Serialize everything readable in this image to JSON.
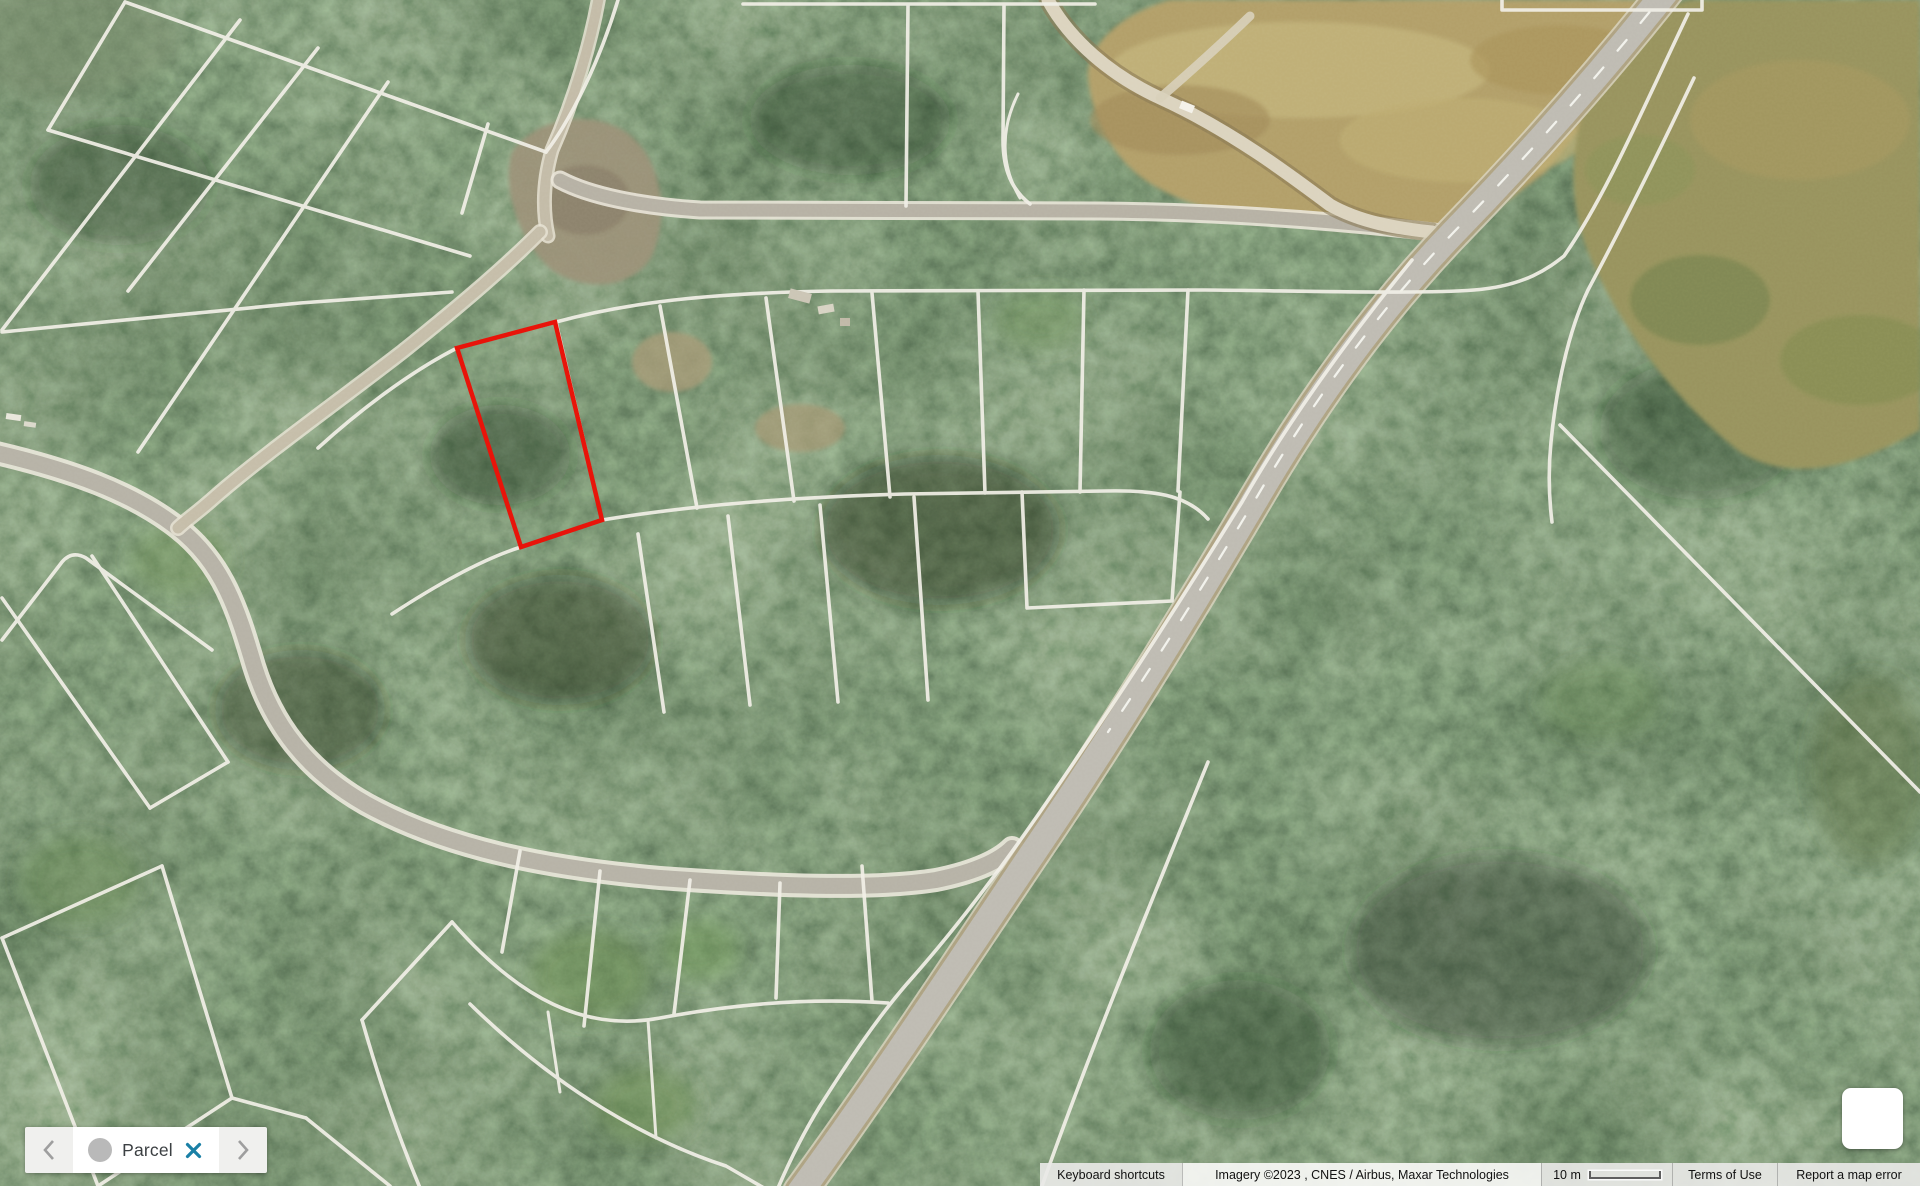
{
  "map": {
    "type": "satellite-imagery",
    "highlighted_parcel_color": "#e81309",
    "parcel_line_color": "#f1efe7"
  },
  "parcel_chip": {
    "label": "Parcel",
    "prev_icon": "chevron-left-icon",
    "next_icon": "chevron-right-icon",
    "close_icon": "close-icon",
    "close_color": "#1a80a6"
  },
  "attribution": {
    "keyboard_shortcuts": "Keyboard shortcuts",
    "imagery_credit": "Imagery ©2023 , CNES / Airbus, Maxar Technologies",
    "scale_label": "10 m",
    "terms_of_use": "Terms of Use",
    "report_error": "Report a map error"
  }
}
